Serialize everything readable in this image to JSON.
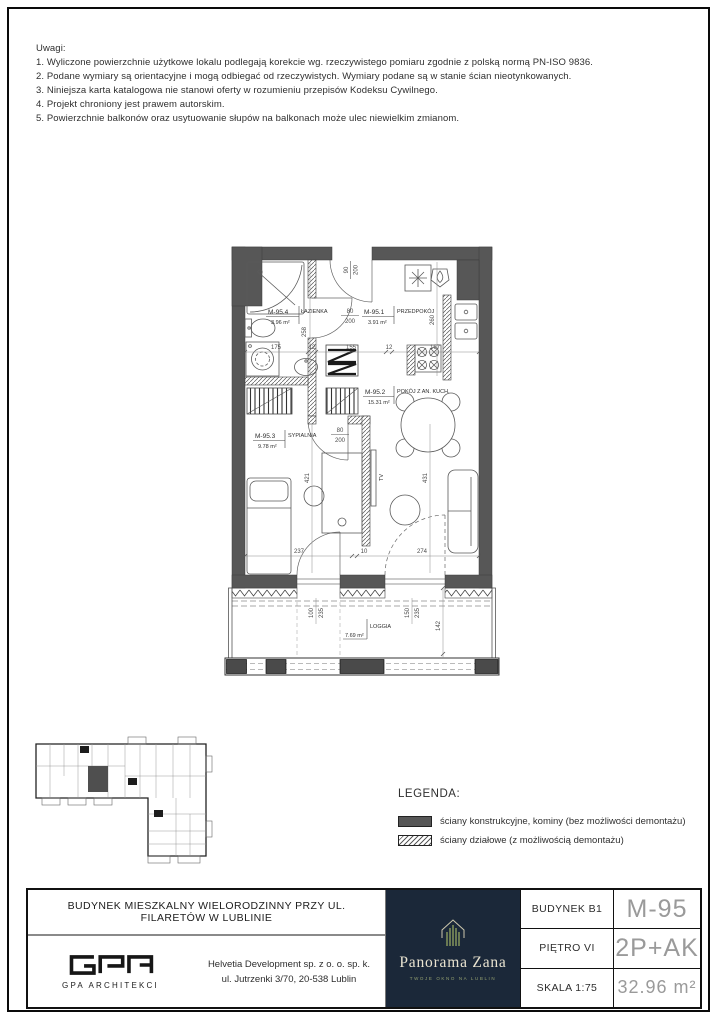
{
  "notes": {
    "title": "Uwagi:",
    "items": [
      "1. Wyliczone powierzchnie użytkowe lokalu podlegają korekcie wg. rzeczywistego pomiaru zgodnie z polską normą PN-ISO 9836.",
      "2. Podane wymiary są orientacyjne i mogą odbiegać od rzeczywistych. Wymiary podane są w stanie ścian nieotynkowanych.",
      "3. Niniejsza karta katalogowa nie stanowi oferty w rozumieniu przepisów Kodeksu Cywilnego.",
      "4. Projekt chroniony jest prawem autorskim.",
      "5. Powierzchnie balkonów oraz usytuowanie słupów na balkonach może ulec niewielkim zmianom."
    ]
  },
  "plan": {
    "rooms": [
      {
        "code": "M-95.4",
        "name": "ŁAZIENKA",
        "area": "3.96 m²"
      },
      {
        "code": "M-95.1",
        "name": "PRZEDPOKÓJ",
        "area": "3.91 m²"
      },
      {
        "code": "M-95.2",
        "name": "POKÓJ Z AN. KUCH.",
        "area": "15.31 m²"
      },
      {
        "code": "M-95.3",
        "name": "SYPIALNIA",
        "area": "9.78 m²"
      },
      {
        "code": "",
        "name": "LOGGIA",
        "area": "7.69 m²"
      }
    ],
    "doors": [
      {
        "w": "90",
        "h": "200"
      },
      {
        "w": "80",
        "h": "200"
      },
      {
        "w": "80",
        "h": "200"
      }
    ],
    "dims": {
      "chain_top": [
        "175",
        "12",
        "155",
        "12",
        "167"
      ],
      "chain_bottom": [
        "237",
        "10",
        "274"
      ],
      "bath_height": "258",
      "hall_height": "260",
      "bedroom_height": "421",
      "living_height": "431",
      "window_left": [
        "100",
        "235"
      ],
      "window_right": [
        "150",
        "235"
      ],
      "loggia_depth": "142"
    },
    "tv_label": "TV"
  },
  "legend": {
    "title": "LEGENDA:",
    "items": [
      {
        "label": "ściany konstrukcyjne, kominy (bez możliwości demontażu)"
      },
      {
        "label": "ściany działowe (z możliwością demontażu)"
      }
    ]
  },
  "title_block": {
    "project_title": "BUDYNEK MIESZKALNY WIELORODZINNY PRZY UL. FILARETÓW W LUBLINIE",
    "architect_label": "GPA ARCHITEKCI",
    "developer_line1": "Helvetia Development sp. z o. o. sp. k.",
    "developer_line2": "ul. Jutrzenki 3/70, 20-538 Lublin",
    "brand": {
      "name": "Panorama Zana",
      "tagline": "TWOJE OKNO NA LUBLIN"
    },
    "rows": [
      {
        "label": "BUDYNEK B1",
        "value": "M-95"
      },
      {
        "label": "PIĘTRO VI",
        "value": "2P+AK"
      },
      {
        "label": "SKALA 1:75",
        "value": "32.96 m²"
      }
    ]
  },
  "colors": {
    "wall": "#575757",
    "navy": "#1b2839",
    "brand_green": "#7f8f5a",
    "brand_cream": "#e9e3d0"
  }
}
